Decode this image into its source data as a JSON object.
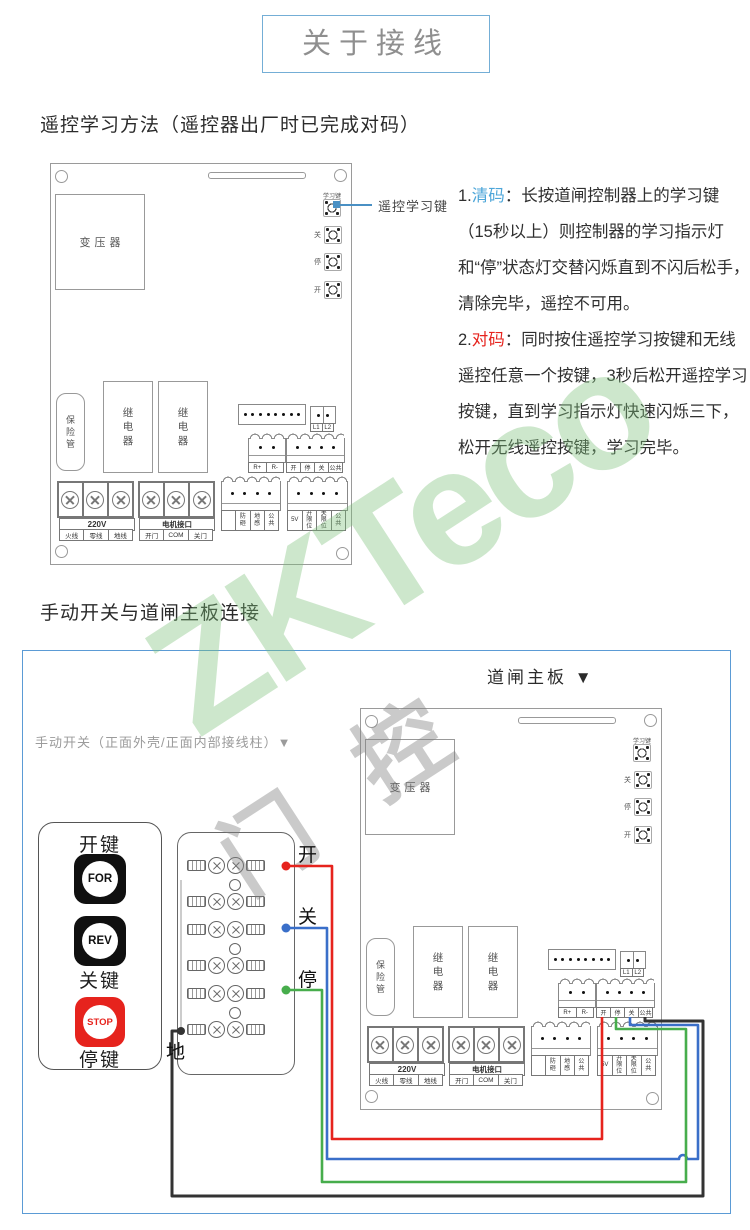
{
  "title": "关于接线",
  "sections": {
    "s1_heading": "遥控学习方法（遥控器出厂时已完成对码）",
    "s2_heading": "手动开关与道闸主板连接"
  },
  "instructions": {
    "p1_num": "1.",
    "p1_key": "清码",
    "p1_text": "：长按道闸控制器上的学习键（15秒以上）则控制器的学习指示灯和“停”状态灯交替闪烁直到不闪后松手，清除完毕，遥控不可用。",
    "p2_num": "2.",
    "p2_key": "对码",
    "p2_text": "：同时按住遥控学习按键和无线遥控任意一个按键，3秒后松开遥控学习按键，直到学习指示灯快速闪烁三下，松开无线遥控按键，学习完毕。",
    "key1_color": "#4da6d9",
    "key2_color": "#e6231d"
  },
  "board": {
    "transformer": "变压器",
    "learn_key_label": "学习键",
    "btn_close": "关",
    "btn_stop": "停",
    "btn_open": "开",
    "fuse": "保险管",
    "relay1": "继电器",
    "relay2": "继电器",
    "l1": "L1",
    "l2": "L2",
    "r_plus": "R+",
    "r_minus": "R-",
    "io_pins": [
      "开",
      "停",
      "关",
      "公共"
    ],
    "power_label": "220V",
    "power_pins": [
      "火线",
      "零线",
      "地线"
    ],
    "motor_label": "电机接口",
    "motor_pins": [
      "开门",
      "COM",
      "关门"
    ],
    "sensor_pins": [
      "",
      "防砸",
      "地感",
      "公共"
    ],
    "limit_pins": [
      "5V",
      "开限位",
      "关限位",
      "公共"
    ]
  },
  "callout": {
    "label": "遥控学习键",
    "color": "#4a90c4"
  },
  "diagram2": {
    "board_title": "道闸主板 ▼",
    "switch_caption": "手动开关（正面外壳/正面内部接线柱）▼",
    "open_key": "开键",
    "close_key": "关键",
    "stop_key": "停键",
    "for_btn": "FOR",
    "rev_btn": "REV",
    "stop_btn": "STOP",
    "wire_open": "开",
    "wire_close": "关",
    "wire_stop": "停",
    "wire_ground": "地",
    "colors": {
      "open_wire": "#e6231d",
      "close_wire": "#3a6fc9",
      "stop_wire": "#47ad4c",
      "ground_wire": "#333333",
      "frame": "#5b9bd5",
      "stop_button": "#e6231d"
    }
  },
  "watermark": {
    "text": "ZKTeco",
    "char1": "门",
    "char2": "控"
  }
}
